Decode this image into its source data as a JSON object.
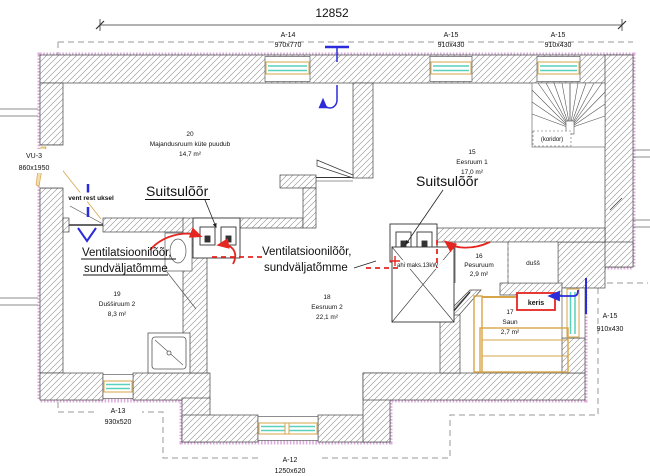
{
  "title": "Korruseplaan / floor plan working drawing",
  "dimension": {
    "total_width": "12852"
  },
  "openings": {
    "a14_top": {
      "code": "A-14",
      "size": "970x770"
    },
    "a15_top_1": {
      "code": "A-15",
      "size": "910x430"
    },
    "a15_top_2": {
      "code": "A-15",
      "size": "910x430"
    },
    "a15_right": {
      "code": "A-15",
      "size": "910x430"
    },
    "a13_bottom": {
      "code": "A-13",
      "size": "930x520"
    },
    "a12_bottom": {
      "code": "A-12",
      "size": "1250x620"
    },
    "vu3_left": {
      "code": "VU-3",
      "size": "860x1950"
    }
  },
  "rooms": {
    "r20": {
      "number": "20",
      "name": "Majandusruum  küte puudub",
      "area": "14,7 m²"
    },
    "r15": {
      "number": "15",
      "name": "Eesruum 1",
      "area": "17,0 m²"
    },
    "r16": {
      "number": "16",
      "name": "Pesuruum",
      "area": "2,9 m²"
    },
    "r17": {
      "number": "17",
      "name": "Saun",
      "area": "2,7 m²"
    },
    "r18": {
      "number": "18",
      "name": "Eesruum 2",
      "area": "22,1 m²"
    },
    "r19": {
      "number": "19",
      "name": "Dušširuum 2",
      "area": "8,3 m²"
    }
  },
  "labels": {
    "koridor": "(koridor)",
    "duss": "dušš",
    "keris": "keris",
    "stove": "ahi maks.13kW",
    "vent_rest_uksel": "vent rest uksel"
  },
  "annotations": {
    "suitsuloor_left": "Suitsulõõr",
    "suitsuloor_right": "Suitsulõõr",
    "vent_left_line1": "Ventilatsioonilõõr,",
    "vent_left_line2": "sundväljatõmme",
    "vent_right_line1": "Ventilatsioonilõõr,",
    "vent_right_line2": "sundväljatõmme"
  },
  "colors": {
    "wall_hatch": "#8f8f8f",
    "outer_insulation": "#d9a3d9",
    "window_glass": "#59d1bd",
    "woodwork": "#d7a548",
    "airflow_red": "#e52520",
    "vent_blue": "#2b2bdc",
    "dashed_boundary": "#9a9a9a"
  }
}
